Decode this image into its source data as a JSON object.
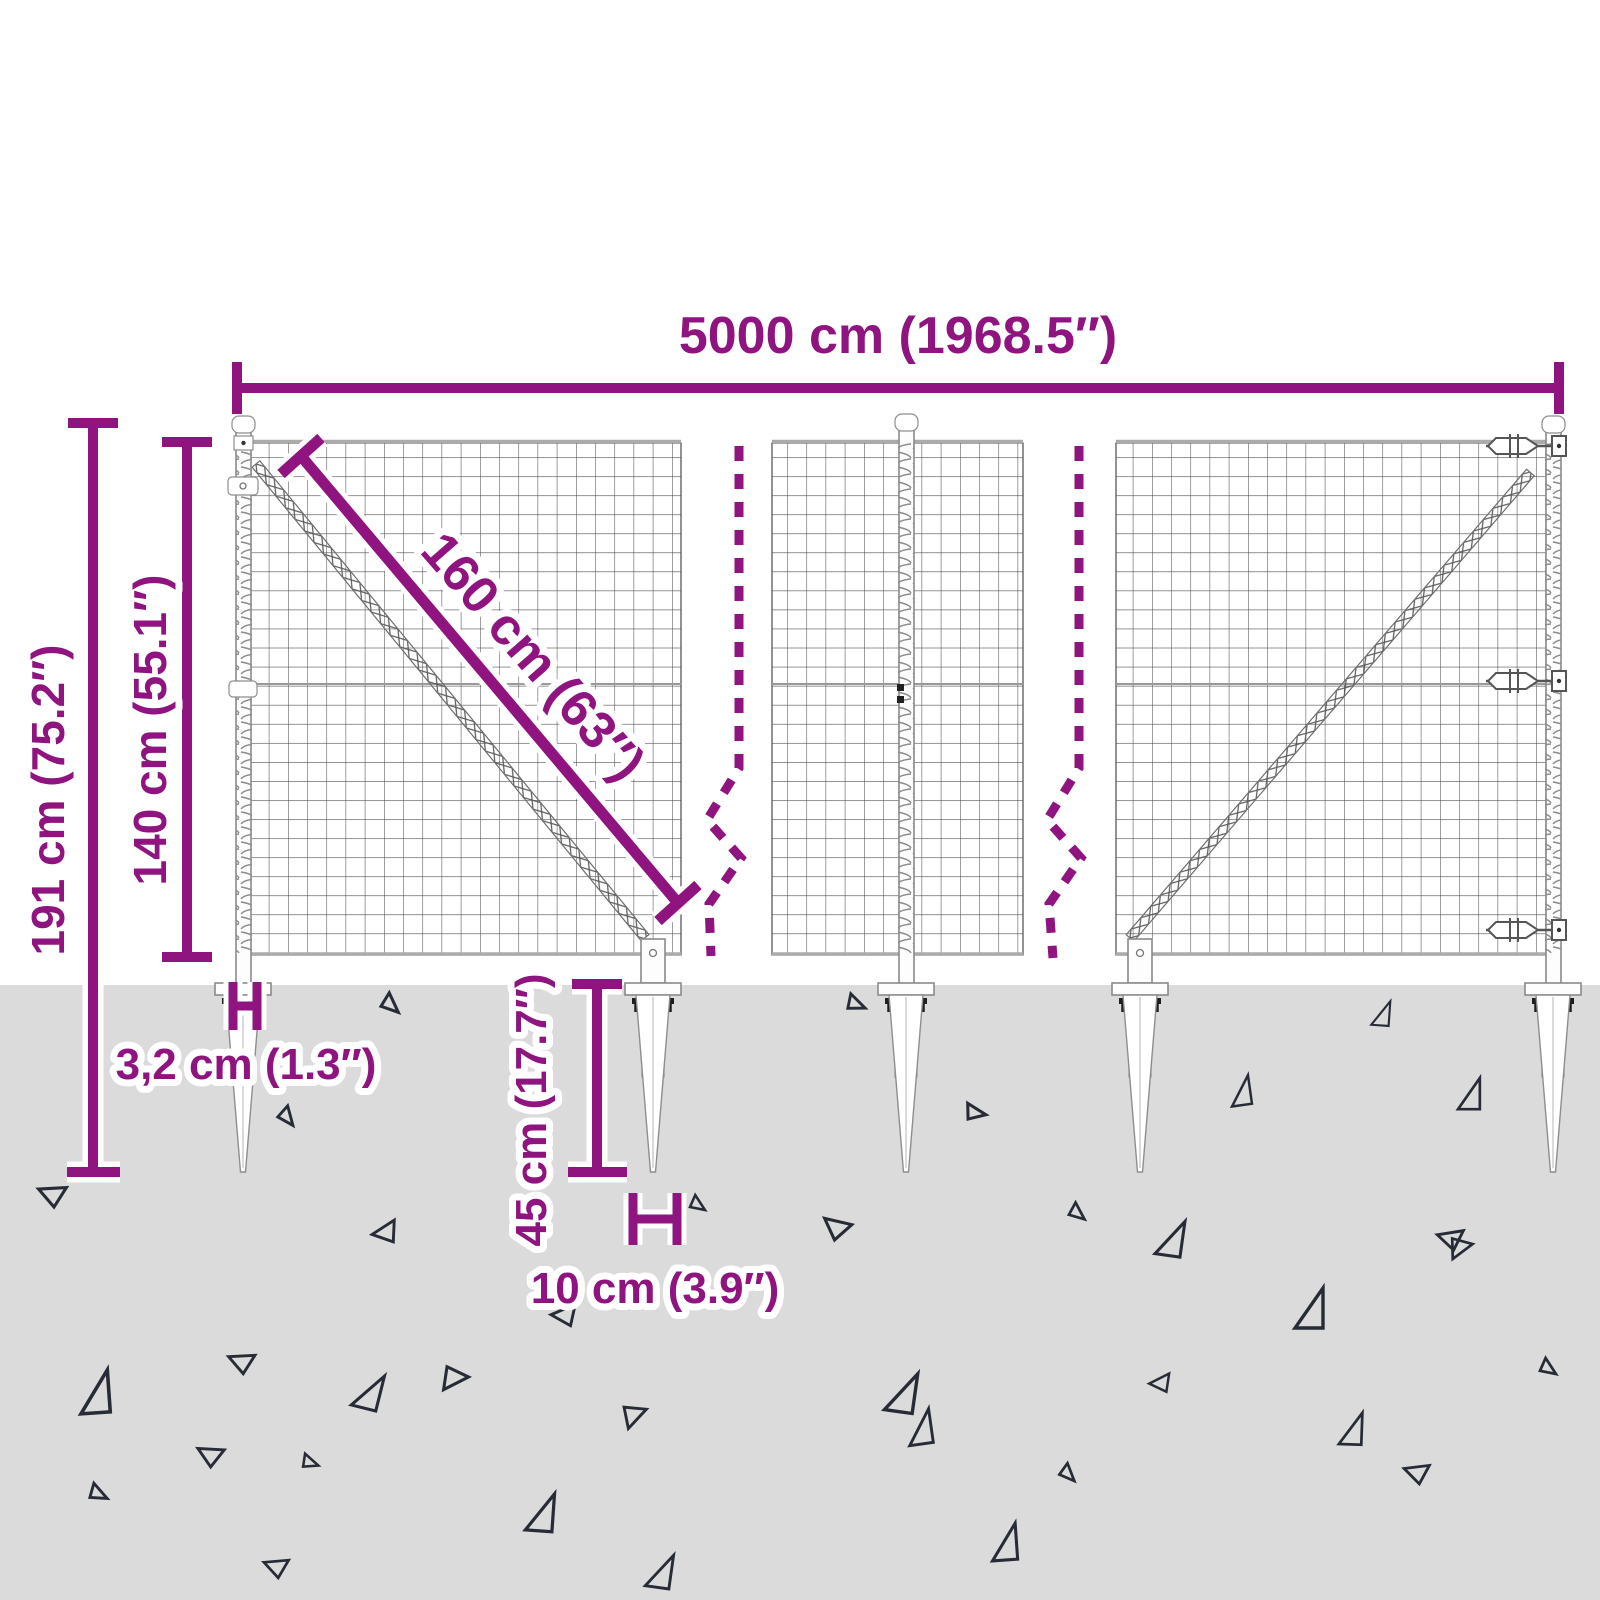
{
  "diagram": {
    "title": "wire-mesh-fence-dimension-diagram",
    "dimensions": {
      "total_width": "5000 cm (1968.5″)",
      "total_height": "191 cm (75.2″)",
      "mesh_height": "140 cm (55.1″)",
      "mesh_diagonal": "160 cm (63″)",
      "post_width": "3,2 cm (1.3″)",
      "spike_length": "45 cm (17.7″)",
      "spike_width": "10 cm (3.9″)"
    },
    "colors": {
      "accent": "#8F1480",
      "ground": "#DBDBDB",
      "line_dark": "#4A4A4A",
      "triangle": "#262B36",
      "structure": "#8A8A8A",
      "background": "#FFFFFF"
    }
  }
}
